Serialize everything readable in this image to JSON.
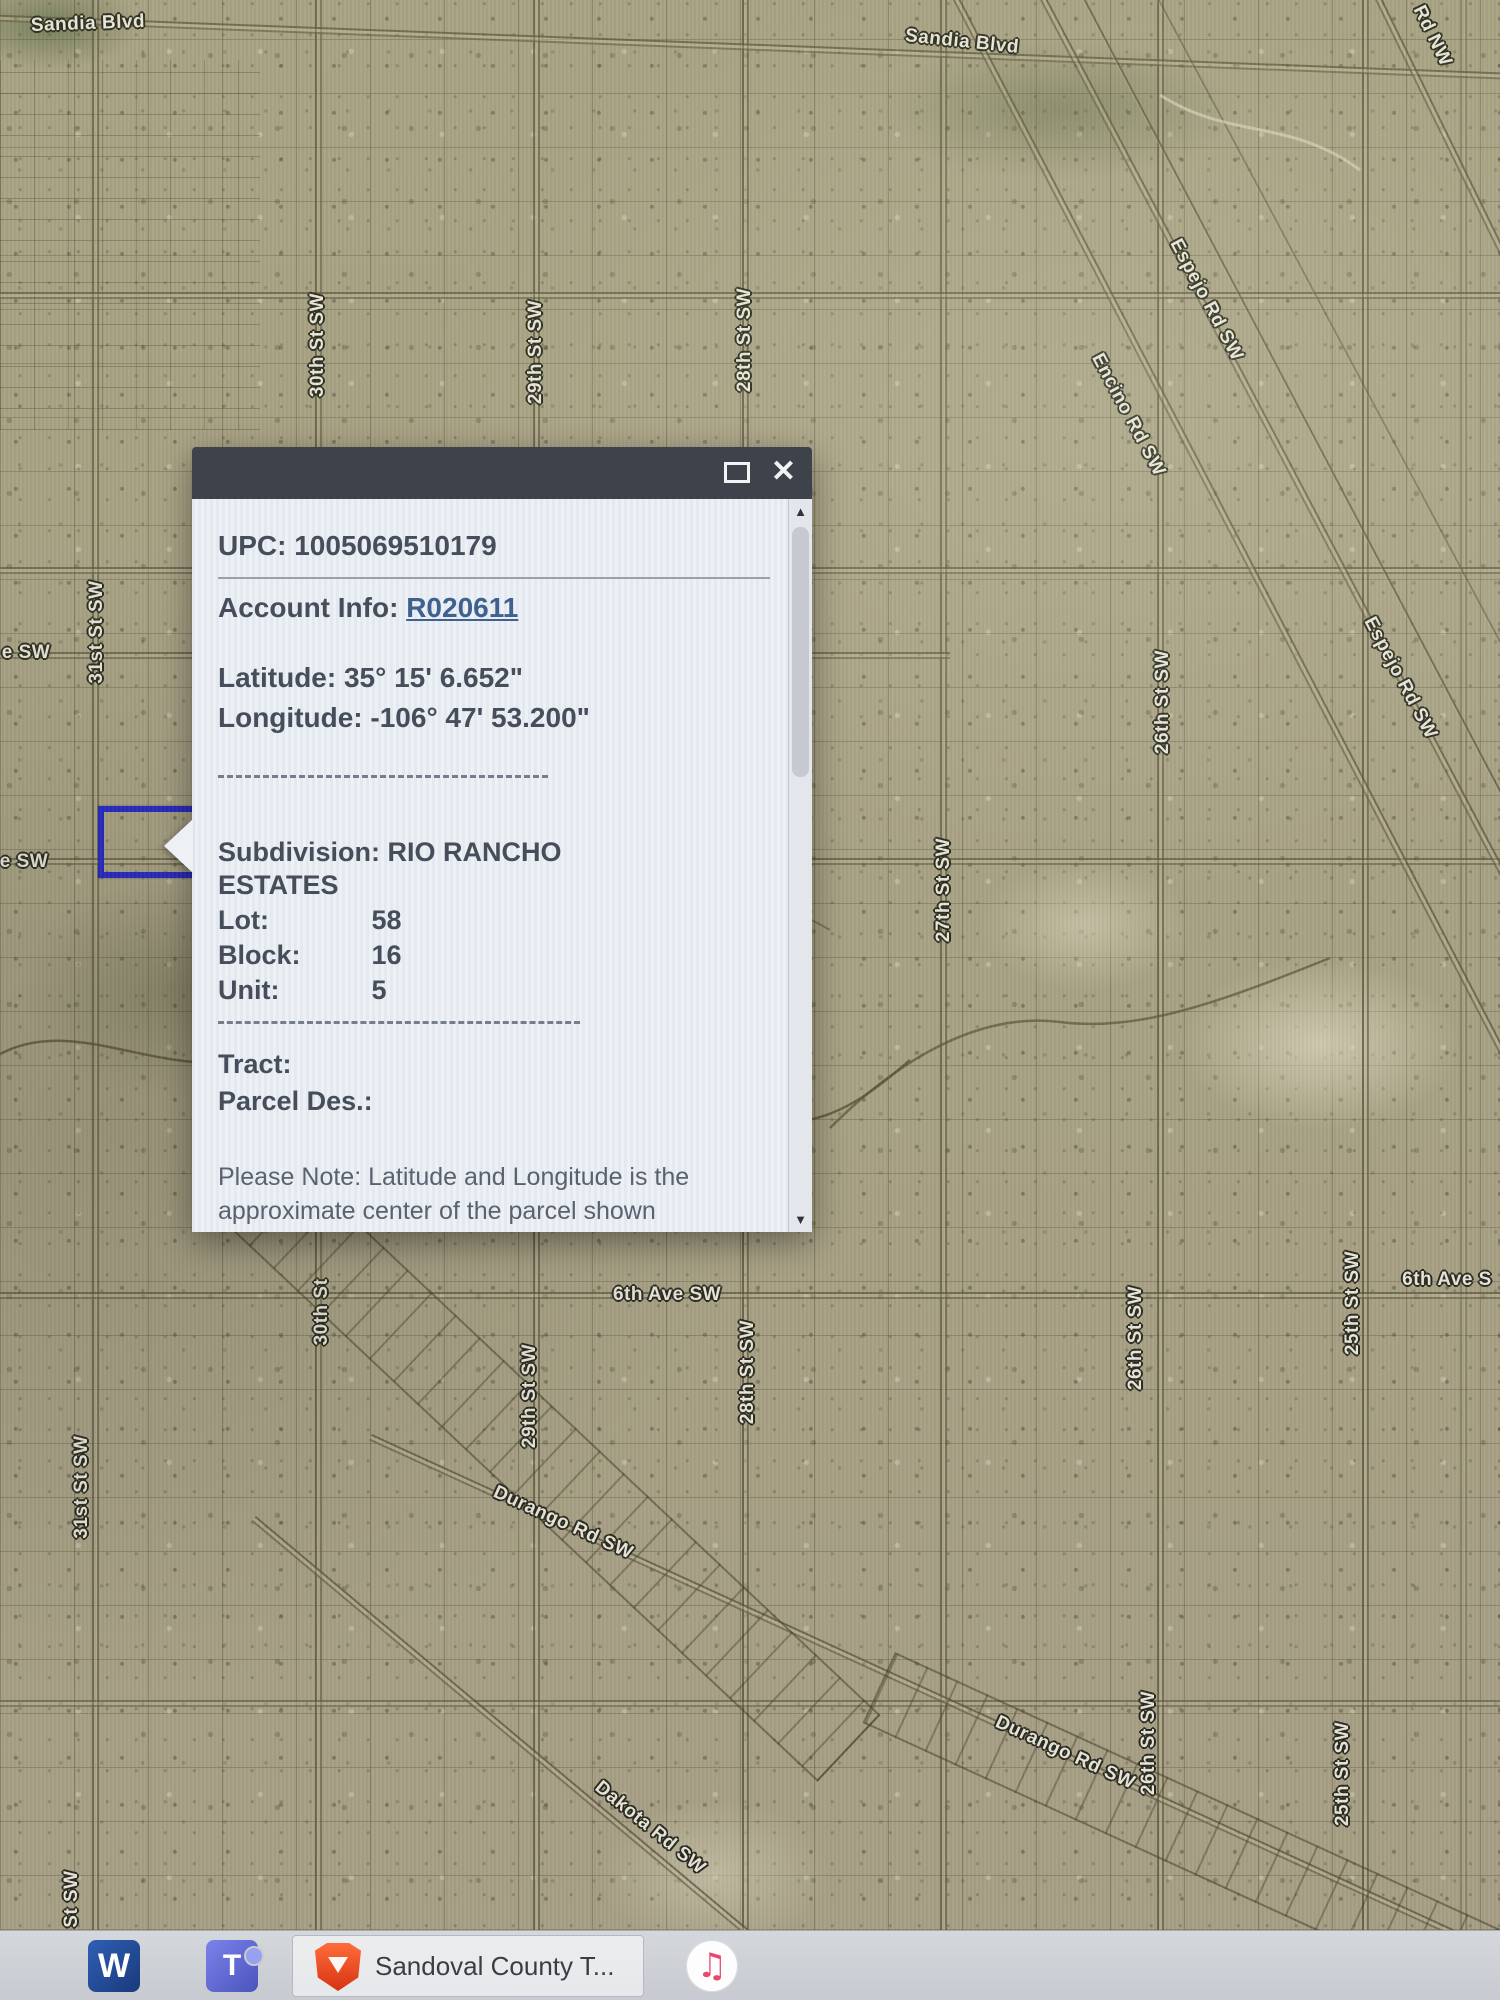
{
  "popup": {
    "upc": "UPC: 1005069510179",
    "account_label": "Account Info:",
    "account_value": "R020611",
    "latitude": "Latitude: 35° 15' 6.652\"",
    "longitude": "Longitude: -106° 47' 53.200\"",
    "subdivision": "Subdivision: RIO RANCHO ESTATES",
    "rows": [
      {
        "label": "Lot:",
        "value": "58"
      },
      {
        "label": "Block:",
        "value": "16"
      },
      {
        "label": "Unit:",
        "value": "5"
      }
    ],
    "tract_label": "Tract:",
    "parcel_des_label": "Parcel Des.:",
    "note": "Please Note: Latitude and Longitude is the approximate center of the parcel shown"
  },
  "icons": {
    "close": "✕",
    "scroll_up": "▲",
    "scroll_down": "▼",
    "music_note": "♫"
  },
  "map": {
    "labels": [
      {
        "text": "Sandia Blvd"
      },
      {
        "text": "Sandia Blvd"
      },
      {
        "text": "Rd NW"
      },
      {
        "text": "30th St SW"
      },
      {
        "text": "29th St SW"
      },
      {
        "text": "28th St SW"
      },
      {
        "text": "26th St SW"
      },
      {
        "text": "27th St SW"
      },
      {
        "text": "31st St SW"
      },
      {
        "text": "e SW"
      },
      {
        "text": "e SW"
      },
      {
        "text": "Espejo Rd SW"
      },
      {
        "text": "Encino Rd SW"
      },
      {
        "text": "Espejo Rd SW"
      },
      {
        "text": "26th St SW"
      },
      {
        "text": "26th St SW"
      },
      {
        "text": "25th St SW"
      },
      {
        "text": "25th St SW"
      },
      {
        "text": "6th Ave SW"
      },
      {
        "text": "6th Ave S"
      },
      {
        "text": "30th St"
      },
      {
        "text": "29th St SW"
      },
      {
        "text": "28th St SW"
      },
      {
        "text": "Durango Rd SW"
      },
      {
        "text": "Durango Rd SW"
      },
      {
        "text": "Dakota Rd SW"
      },
      {
        "text": "31st St SW"
      },
      {
        "text": "31st St SW"
      }
    ]
  },
  "taskbar": {
    "word_label": "W",
    "teams_label": "T",
    "active_window_title": "Sandoval County T..."
  },
  "colors": {
    "selection_blue": "#2222cf",
    "popup_titlebar": "#3e434b",
    "account_link": "#3f618f",
    "map_base_tan": "#aea689",
    "brave_orange": "#e8441f"
  }
}
